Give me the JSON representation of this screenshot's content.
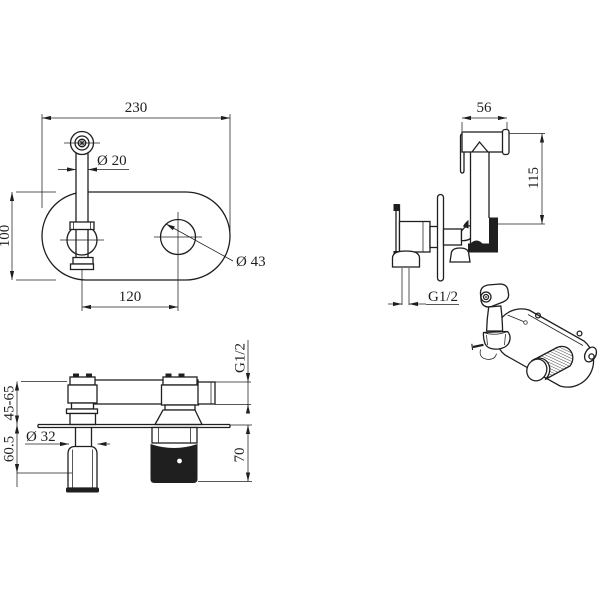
{
  "drawing": {
    "background": "#ffffff",
    "line_color": "#1f1f1f",
    "views": {
      "plate_front": {
        "label": "wall plate front view",
        "dim_width": "230",
        "dim_spout_diameter": "Ø 20",
        "dim_plate_height": "100",
        "dim_hole_diameter": "Ø 43",
        "dim_hole_spacing": "120"
      },
      "sprayer_side": {
        "label": "hand sprayer side view",
        "dim_head_width": "56",
        "dim_height": "115",
        "dim_outlet_thread": "G1/2"
      },
      "mixer_side": {
        "label": "concealed mixer side view",
        "dim_depth_range": "45-65",
        "dim_spout_drop": "60.5",
        "dim_spout_diameter": "Ø 32",
        "dim_handle_drop": "70",
        "dim_outlet_thread": "G1/2"
      },
      "isometric": {
        "label": "assembled product isometric sketch"
      }
    }
  }
}
